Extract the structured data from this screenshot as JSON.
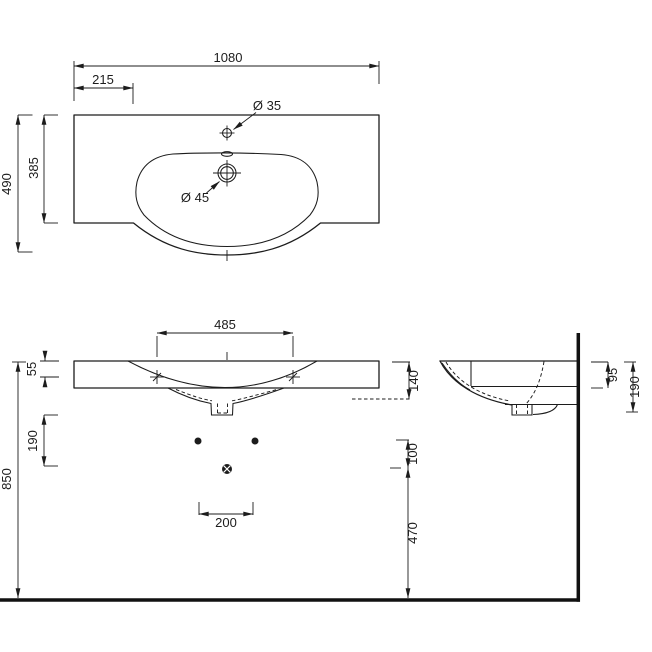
{
  "colors": {
    "ink": "#1c1c1c",
    "background": "#ffffff"
  },
  "top_view": {
    "overall_width": "1080",
    "ledge_width": "215",
    "overall_depth": "490",
    "deck_depth": "385",
    "tap_hole": "Ø 35",
    "waste_hole": "Ø 45"
  },
  "front_view": {
    "fixing_centres": "485",
    "deck_to_fixing": "55",
    "basin_to_trap": "190",
    "rim_height": "850",
    "bowl_depth": "140",
    "trap_offset": "100",
    "trap_to_floor": "470",
    "waste_centres": "200"
  },
  "side_view": {
    "deck_front": "95",
    "deck_overall": "190"
  }
}
